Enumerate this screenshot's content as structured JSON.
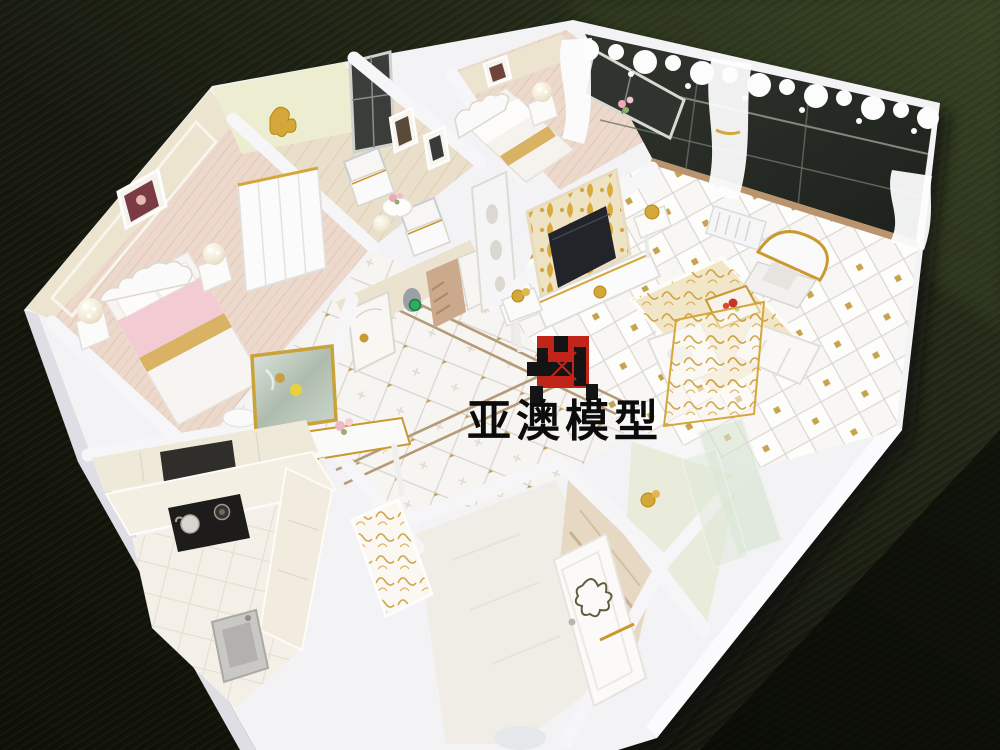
{
  "scene": {
    "type": "photograph",
    "subject": "miniature apartment interior scale model viewed from above on a dark wooden table",
    "table_color": "#12140c",
    "table_sheen_color": "#3c4a2c",
    "model_board_color": "#f3f2f5",
    "wall_cream_color": "#ece4cf",
    "gold_accent_color": "#c9992f"
  },
  "watermark": {
    "text": "亚澳模型",
    "logo_name": "red-black-interlocked-square-logo",
    "logo_red": "#c1251a",
    "logo_black": "#141414"
  },
  "rooms": [
    {
      "name": "master-bedroom",
      "items": [
        "ornate-bed",
        "pink-bedding",
        "pearl-ball-lamps",
        "wardrobe",
        "wall-picture"
      ]
    },
    {
      "name": "foyer-sitting-area",
      "items": [
        "gold-horse-ornament",
        "dark-window",
        "two-armchairs",
        "round-flower-table",
        "wall-frames",
        "pearl-ball"
      ]
    },
    {
      "name": "second-bedroom",
      "items": [
        "bed",
        "pearl-lamp",
        "sheer-curtain",
        "dark-window",
        "pink-flowers",
        "wall-picture"
      ]
    },
    {
      "name": "living-room",
      "items": [
        "glass-window-wall",
        "lace-valance",
        "tied-curtains",
        "gold-tv-wall",
        "tv-screen",
        "tv-stand",
        "ornate-gold-armchair",
        "gold-scroll-rug",
        "coffee-table-red-flowers",
        "white-sofa",
        "gold-filigree-screen",
        "air-conditioner"
      ]
    },
    {
      "name": "hallway",
      "items": [
        "diamond-tile-floor",
        "tan-border-inlay",
        "arched-doors",
        "jade-ornament",
        "pedestal-table-gold-bow"
      ]
    },
    {
      "name": "dining-nook",
      "items": [
        "gold-framed-mirror",
        "console-table",
        "pink-flowers"
      ]
    },
    {
      "name": "kitchen",
      "items": [
        "range-hood",
        "gas-stove-kettle",
        "l-shaped-counter",
        "sink",
        "gold-scroll-glass-door"
      ]
    },
    {
      "name": "bathroom",
      "items": [
        "ornate-open-door",
        "beige-tile-wall"
      ]
    },
    {
      "name": "balcony",
      "items": [
        "celadon-floor",
        "leaning-glass-sheets",
        "gold-ornament"
      ]
    }
  ]
}
